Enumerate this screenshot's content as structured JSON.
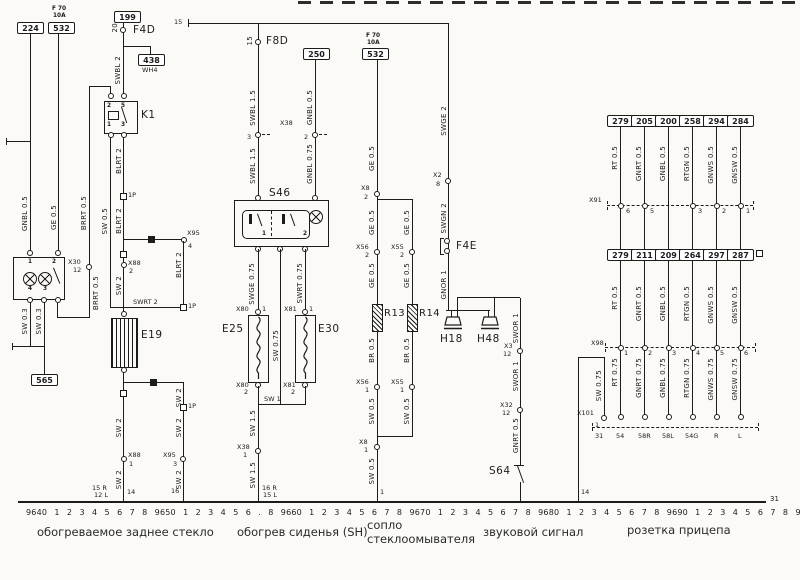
{
  "colors": {
    "bg": "#fbfaf7",
    "ink": "#1c1c1c"
  },
  "tp": {
    "bus": "15"
  },
  "rw": {
    "b224": "224",
    "f70": "F 70",
    "f70a": "10A",
    "b532": "532",
    "b199": "199",
    "p20": "20",
    "f4d": "F4D",
    "b438": "438",
    "wh4": "WH4",
    "swbl": "SWBL 2",
    "k1": "K1",
    "k1p2": "2",
    "k1p5": "5",
    "k1p1": "1",
    "k1p3": "3",
    "gnbl": "GNBL 0.5",
    "ge": "GE 0.5",
    "brrt1": "BRRT 0.5",
    "x30": "X30",
    "x30p": "12",
    "brrt2": "BRRT 0.5",
    "lp1": "1",
    "lp2": "2",
    "lp4": "4",
    "lp3": "3",
    "sw03a": "SW 0.3",
    "sw03b": "SW 0.3",
    "b565": "565",
    "sw05": "SW 0.5",
    "blrt1": "BLRT 2",
    "p1a": "1P",
    "blrt2": "BLRT 2",
    "x95a": "X95",
    "x95ap": "4",
    "blrt3": "BLRT 2",
    "p1b": "1P",
    "swrt": "SWRT 2",
    "x88a": "X88",
    "x88ap": "2",
    "sw2a": "SW 2",
    "e19": "E19",
    "sw2b": "SW 2",
    "x88b": "X88",
    "x88bp": "1",
    "sw2c": "SW 2",
    "g14": "14",
    "sw2d": "SW 2",
    "p1c": "1P",
    "sw2e": "SW 2",
    "x95b": "X95",
    "x95bp": "3",
    "sw2f": "SW 2",
    "g16": "16",
    "gl1": "15 R",
    "gl2": "12 L"
  },
  "sh": {
    "t15": "15",
    "f8d": "F8D",
    "b250": "250",
    "swbl1": "SWBL 1.5",
    "gnbl1": "GNBL 0.5",
    "x38": "X38",
    "x38p3": "3",
    "x38p2": "2",
    "swbl2": "SWBL 1.5",
    "gnbl2": "GNBL 0.75",
    "s46": "S46",
    "s46p1": "1",
    "s46p2": "2",
    "swge": "SWGE 0.75",
    "sw075": "SW 0.75",
    "swrt": "SWRT 0.75",
    "x80": "X80",
    "x80p1": "1",
    "e25": "E25",
    "x80p2": "2",
    "x81": "X81",
    "x81p1": "1",
    "e30": "E30",
    "x81p2": "2",
    "sw1": "SW 1",
    "sw15a": "SW 1.5",
    "x38b": "X38",
    "x38bp": "1",
    "sw15b": "SW 1.5",
    "gl1": "16 R",
    "gl2": "15 L"
  },
  "wn": {
    "f70": "F 70",
    "f70a": "10A",
    "b532": "532",
    "ge1": "GE 0.5",
    "x8": "X8",
    "x8p2": "2",
    "ge2": "GE 0.5",
    "ge3": "GE 0.5",
    "x56": "X56",
    "x56p2": "2",
    "x55": "X55",
    "x55p2": "2",
    "ge4": "GE 0.5",
    "ge5": "GE 0.5",
    "r13": "R13",
    "r14": "R14",
    "br1": "BR 0.5",
    "br2": "BR 0.5",
    "x56b": "X56",
    "x56p1": "1",
    "x55b": "X55",
    "x55p1": "1",
    "swa": "SW 0.5",
    "swb": "SW 0.5",
    "x8b": "X8",
    "x8p1": "1",
    "swc": "SW 0.5",
    "g1": "1"
  },
  "hn": {
    "swge": "SWGE 2",
    "x2": "X2",
    "x2p": "8",
    "swgn": "SWGN 2",
    "f4e": "F4E",
    "gnor": "GNOR 1",
    "h18": "H18",
    "h48": "H48",
    "swor1": "SWOR 1",
    "x3": "X3",
    "x3p": "12",
    "swor2": "SWOR 1",
    "x32": "X32",
    "x32p": "12",
    "gnrt": "GNRT 0.5",
    "s64": "S64"
  },
  "tr": {
    "r1": [
      "279",
      "205",
      "200",
      "258",
      "294",
      "284"
    ],
    "w1": [
      "RT 0.5",
      "GNRT 0.5",
      "GNBL 0.5",
      "RTGN 0.5",
      "GNWS 0.5",
      "GNSW 0.5"
    ],
    "x91": "X91",
    "x91p": [
      "6",
      "5",
      "3",
      "2",
      "1"
    ],
    "r2": [
      "279",
      "211",
      "209",
      "264",
      "297",
      "287"
    ],
    "w2": [
      "RT 0.5",
      "GNRT 0.5",
      "GNBL 0.5",
      "RTGN 0.5",
      "GNWS 0.5",
      "GNSW 0.5"
    ],
    "x98": "X98",
    "x98p": [
      "1",
      "2",
      "3",
      "4",
      "5",
      "6"
    ],
    "w3": [
      "RT 0.75",
      "GNRT 0.75",
      "GNBL 0.75",
      "RTGN 0.75",
      "GNWS 0.75",
      "GNSW 0.75"
    ],
    "sw075": "SW 0.75",
    "x101": "X101",
    "x101p": "1",
    "t31": "31",
    "g14": "14",
    "terms": [
      "54",
      "58R",
      "58L",
      "54G",
      "R",
      "L"
    ]
  },
  "bt": {
    "tracks": "9640 1 2 3 4 5 6 7 8 9650 1 2 3 4 5 6 . 8 9660 1 2 3 4 5 6 7 8 9670 1 2 3 4 5 6 7 8 9680 1 2 3 4 5 6 7 8 9690 1 2 3 4 5 6 7 8 9",
    "g31": "31",
    "cap1": "обогреваемое заднее стекло",
    "cap2": "обогрев сиденья (SH)",
    "cap3a": "сопло",
    "cap3b": "стеклоомывателя",
    "cap4": "звуковой сигнал",
    "cap5": "розетка прицепа"
  }
}
